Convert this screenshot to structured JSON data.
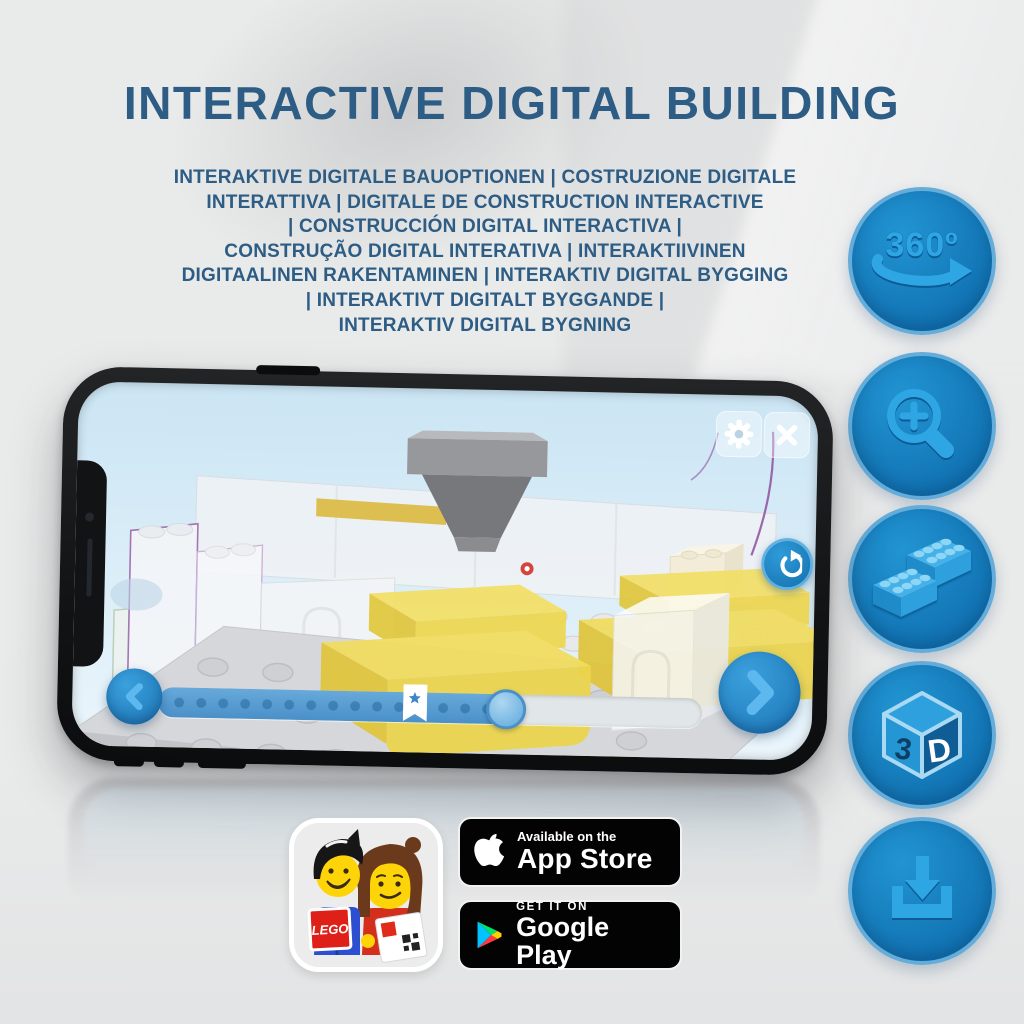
{
  "title": "INTERACTIVE DIGITAL BUILDING",
  "subtitle_lines": [
    "INTERAKTIVE DIGITALE BAUOPTIONEN | COSTRUZIONE DIGITALE",
    "INTERATTIVA | DIGITALE DE CONSTRUCTION INTERACTIVE",
    "| CONSTRUCCIÓN DIGITAL INTERACTIVA |",
    "CONSTRUÇÃO DIGITAL INTERATIVA | INTERAKTIIVINEN",
    "DIGITAALINEN RAKENTAMINEN | INTERAKTIV DIGITAL BYGGING",
    "| INTERAKTIVT DIGITALT BYGGANDE |",
    "INTERAKTIV DIGITAL BYGNING"
  ],
  "feature_icons": [
    {
      "name": "360-rotation-icon",
      "label": "360º"
    },
    {
      "name": "zoom-in-icon"
    },
    {
      "name": "brick-steps-icon"
    },
    {
      "name": "3d-view-icon",
      "label_left": "3",
      "label_right": "D"
    },
    {
      "name": "download-icon"
    }
  ],
  "phone_app": {
    "progress_percent": 64,
    "bookmark_percent": 45,
    "control_icons": [
      "gear-icon",
      "close-icon",
      "refresh-icon",
      "chevron-left-icon",
      "chevron-right-icon",
      "bookmark-star-icon"
    ]
  },
  "badges": {
    "lego_app_icon_label": "LEGO",
    "app_store": {
      "tagline": "Available on the",
      "store_name": "App Store"
    },
    "google_play": {
      "tagline": "GET IT ON",
      "store_name": "Google Play"
    }
  },
  "colors": {
    "title_blue": "#2d5c84",
    "feature_circle_blue": "#1579ba",
    "feature_glyph_blue": "#2ea6e4",
    "app_accent_blue": "#2f9bd9",
    "brick_yellow": "#f0da55",
    "badge_black": "#030303"
  }
}
